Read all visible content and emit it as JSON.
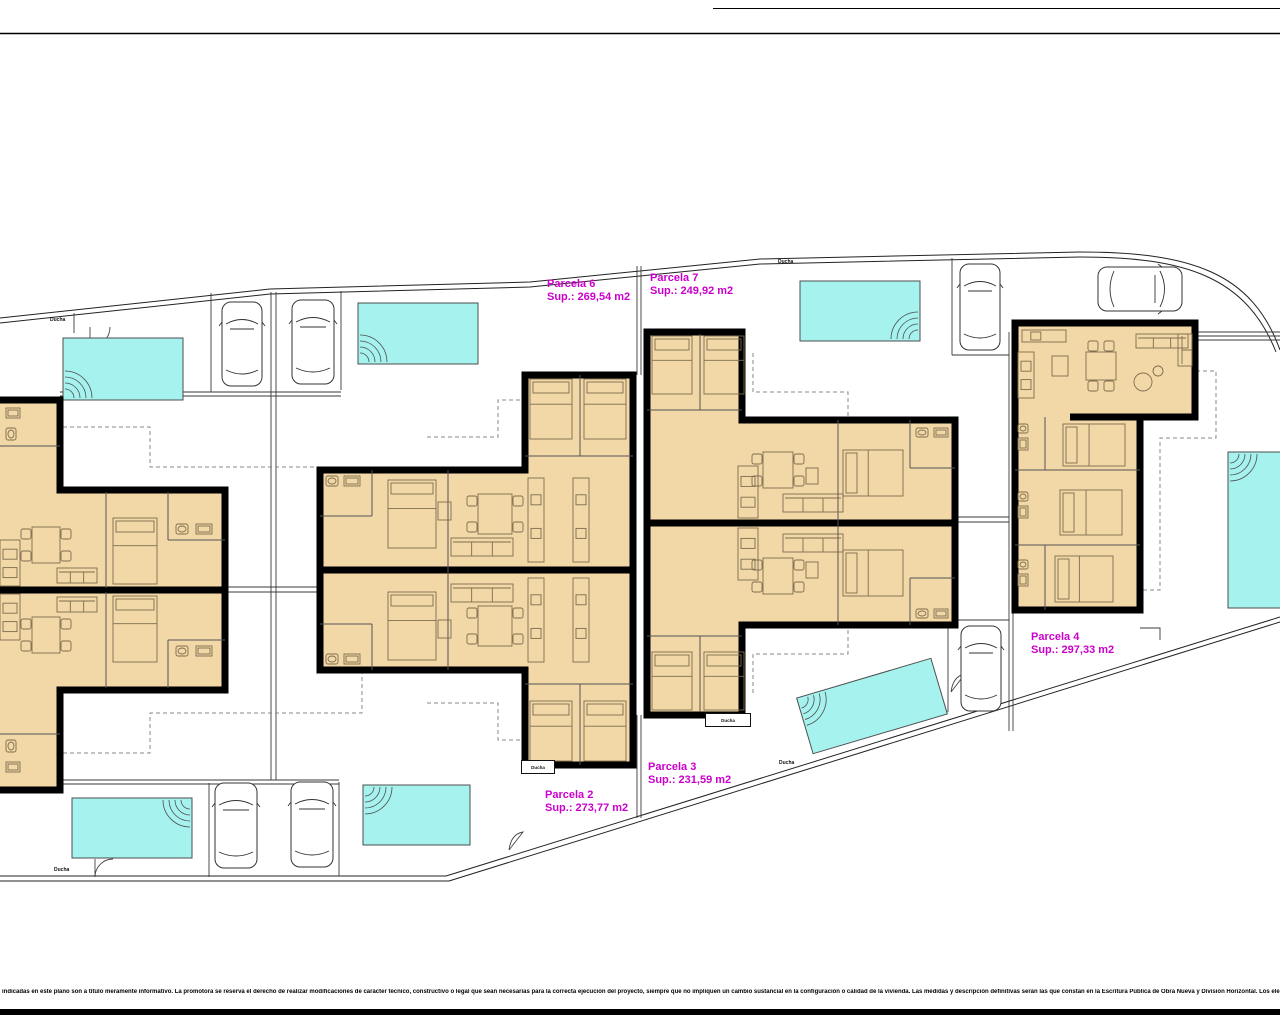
{
  "title": "Plano de distribución de parcelas",
  "colors": {
    "wall": "#000000",
    "room_fill": "#f2d8a7",
    "pool": "#a6f2ef",
    "pool_edge": "#4d4d4d",
    "label": "#cc00cc",
    "line": "#3a3a3a",
    "boundary": "#222222",
    "furniture": "#7d6c4e",
    "dash": "#888888",
    "car_line": "#333333"
  },
  "disclaimer": {
    "text": "indicadas en este plano son a título meramente informativo. La promotora se reserva el derecho de realizar modificaciones de carácter técnico, constructivo o legal que sean necesarias para la correcta ejecución del proyecto, siempre que no impliquen un cambio sustancial en la configuración o calidad de la vivienda. Las medidas y descripción definitivas serán las que constan en la Escritura Pública de Obra Nueva y División Horizontal. Los elementos de mobiliario y decoración son meramente orientativos."
  },
  "parcels": [
    {
      "name": "Parcela 6",
      "sup": "Sup.: 269,54 m2",
      "x": 547,
      "y": 278
    },
    {
      "name": "Parcela 7",
      "sup": "Sup.: 249,92 m2",
      "x": 650,
      "y": 272
    },
    {
      "name": "Parcela 2",
      "sup": "Sup.: 273,77 m2",
      "x": 545,
      "y": 789
    },
    {
      "name": "Parcela 3",
      "sup": "Sup.: 231,59 m2",
      "x": 648,
      "y": 761
    },
    {
      "name": "Parcela 4",
      "sup": "Sup.: 297,33 m2",
      "x": 1031,
      "y": 631
    }
  ],
  "shower_labels": {
    "text": "Ducha",
    "plain": [
      [
        50,
        317
      ],
      [
        778,
        259
      ],
      [
        779,
        760
      ],
      [
        54,
        867
      ]
    ],
    "boxed": [
      [
        521,
        760,
        34,
        14
      ],
      [
        705,
        713,
        46,
        14
      ]
    ]
  },
  "site": {
    "border_lines": [
      "M0,33.5 H1280",
      "M713,8.5 H1280"
    ],
    "bottom_bar": {
      "x": 0,
      "y": 1009,
      "w": 1280,
      "h": 6
    },
    "boundary": [
      "M0,318 L270,289 L530,282 L760,259 L1080,252 C1190,252 1252,272 1280,350",
      "M0,323 L270,294 L530,287 L760,264 L1080,257 C1186,257 1246,277 1276,352",
      "M-2,876 H446",
      "M-2,881 H449",
      "M446,876 L1280,617",
      "M449,881 L1280,622"
    ],
    "thin": [
      "M637,266 V375",
      "M641,266 V375",
      "M637,715 V818",
      "M641,715 V818",
      "M1009,332 V731",
      "M1013,332 V731",
      "M271,292 V780",
      "M276,292 V780",
      "M225,587 H320",
      "M225,592 H320",
      "M955,517 H1009",
      "M955,522 H1009",
      "M1196,332 H1280",
      "M1196,336 H1280",
      "M1196,340 H1280",
      "M211,293 V392",
      "M341,291 V390",
      "M60,392 H341",
      "M60,396 H341",
      "M209,783 V877",
      "M339,782 V876",
      "M60,780 H339",
      "M60,784 H339",
      "M952,258 V355",
      "M952,355 H1009",
      "M948,620 V712",
      "M948,620 H1009",
      "M1140,628 H1160 V640",
      "M74,313 V333"
    ],
    "dashed": [
      "M28,427 H150 V467 H362 V556",
      "M28,753 H150 V713 H362 V628",
      "M427,437 H498 V400 H553",
      "M427,703 H498 V740 H553",
      "M753,353 V392 H848 V418",
      "M753,693 V654 H848 V628",
      "M1196,371 H1216 V438 H1160 V590 H1142"
    ],
    "gates": [
      "M110,327 A20 20 0 0 1 90,347 L90,327",
      "M95,859 L95,877 A18 18 0 0 1 113,859",
      "M509,850 q2,-16 14,-18 l-14,18",
      "M951,692 q2,-16 14,-18 l-14,18"
    ]
  },
  "pools": [
    {
      "x": 63,
      "y": 338,
      "w": 120,
      "h": 62,
      "steps": "bl"
    },
    {
      "x": 358,
      "y": 303,
      "w": 120,
      "h": 61,
      "steps": "bl"
    },
    {
      "x": 800,
      "y": 281,
      "w": 120,
      "h": 60,
      "steps": "br"
    },
    {
      "x": 1228,
      "y": 452,
      "w": 68,
      "h": 156,
      "steps": "tl"
    },
    {
      "x": 72,
      "y": 798,
      "w": 120,
      "h": 60,
      "steps": "tr"
    },
    {
      "x": 363,
      "y": 785,
      "w": 107,
      "h": 60,
      "steps": "tl"
    },
    {
      "x": 802,
      "y": 677,
      "w": 140,
      "h": 58,
      "steps": "tl",
      "rot": -16.5,
      "cx": 872,
      "cy": 706
    }
  ],
  "cars": [
    {
      "x": 222,
      "y": 302,
      "w": 40,
      "h": 84,
      "rot": 0
    },
    {
      "x": 292,
      "y": 300,
      "w": 42,
      "h": 84,
      "rot": 0
    },
    {
      "x": 960,
      "y": 264,
      "w": 40,
      "h": 86,
      "rot": 0
    },
    {
      "x": 1118,
      "y": 247,
      "w": 44,
      "h": 84,
      "rot": 90
    },
    {
      "x": 961,
      "y": 626,
      "w": 40,
      "h": 85,
      "rot": 0
    },
    {
      "x": 215,
      "y": 783,
      "w": 42,
      "h": 85,
      "rot": 0
    },
    {
      "x": 291,
      "y": 782,
      "w": 42,
      "h": 85,
      "rot": 0
    }
  ],
  "houses": [
    {
      "name": "house-pair-parcela-1-5",
      "outline": "M-14,400 H60 V490 H225 V690 H60 V790 H-14 Z",
      "walls": [
        "M-14,590 H225"
      ],
      "partitions": [
        "M106,492 V588",
        "M168,492 V540",
        "M168,540 H225",
        "M0,446 H60",
        "M106,592 V688",
        "M168,640 V688",
        "M168,640 H225",
        "M0,734 H60"
      ],
      "furniture": [
        [
          "table4",
          32,
          527,
          28,
          36
        ],
        [
          "sofa",
          57,
          568,
          40,
          15
        ],
        [
          "bed",
          113,
          518,
          44,
          66
        ],
        [
          "wc",
          176,
          524,
          12,
          10
        ],
        [
          "sink",
          196,
          524,
          16,
          10
        ],
        [
          "counter",
          0,
          540,
          20,
          46
        ],
        [
          "sink",
          6,
          408,
          14,
          10
        ],
        [
          "wc",
          6,
          428,
          10,
          12
        ],
        [
          "table4",
          32,
          617,
          28,
          36
        ],
        [
          "sofa",
          57,
          597,
          40,
          15
        ],
        [
          "bed",
          113,
          596,
          44,
          66
        ],
        [
          "wc",
          176,
          646,
          12,
          10
        ],
        [
          "sink",
          196,
          646,
          16,
          10
        ],
        [
          "counter",
          0,
          594,
          20,
          46
        ],
        [
          "sink",
          6,
          762,
          14,
          10
        ],
        [
          "wc",
          6,
          740,
          10,
          12
        ]
      ]
    },
    {
      "name": "house-pair-parcela-6-2",
      "outline": "M320,470 H525 V375 H633 V765 H525 V670 H320 Z",
      "walls": [
        "M320,570 H633"
      ],
      "partitions": [
        "M372,470 V516",
        "M320,516 H372",
        "M448,470 V570",
        "M580,375 V456",
        "M525,456 H633",
        "M372,624 V670",
        "M320,624 H372",
        "M448,570 V670",
        "M580,684 V765",
        "M525,684 H633"
      ],
      "furniture": [
        [
          "bed",
          388,
          480,
          48,
          68
        ],
        [
          "table4",
          478,
          494,
          34,
          40
        ],
        [
          "sofa",
          451,
          538,
          62,
          18
        ],
        [
          "sq",
          438,
          502,
          13,
          18
        ],
        [
          "wc",
          326,
          476,
          12,
          10
        ],
        [
          "sink",
          344,
          476,
          16,
          10
        ],
        [
          "counter",
          528,
          478,
          16,
          84
        ],
        [
          "counter",
          573,
          478,
          16,
          84
        ],
        [
          "bed",
          530,
          379,
          42,
          60
        ],
        [
          "bed",
          584,
          379,
          42,
          60
        ],
        [
          "bed",
          388,
          592,
          48,
          68
        ],
        [
          "table4",
          478,
          606,
          34,
          40
        ],
        [
          "sofa",
          451,
          584,
          62,
          18
        ],
        [
          "sq",
          438,
          620,
          13,
          18
        ],
        [
          "wc",
          326,
          654,
          12,
          10
        ],
        [
          "sink",
          344,
          654,
          16,
          10
        ],
        [
          "counter",
          528,
          578,
          16,
          84
        ],
        [
          "counter",
          573,
          578,
          16,
          84
        ],
        [
          "bed",
          530,
          701,
          42,
          60
        ],
        [
          "bed",
          584,
          701,
          42,
          60
        ]
      ]
    },
    {
      "name": "house-pair-parcela-7-3",
      "outline": "M647,332 H742 V420 H955 V625 H742 V715 H647 Z",
      "walls": [
        "M647,523 H955"
      ],
      "partitions": [
        "M700,334 V410",
        "M647,410 H742",
        "M838,420 V523",
        "M910,420 V468",
        "M910,468 H955",
        "M700,636 V712",
        "M647,636 H742",
        "M838,523 V625",
        "M910,578 V625",
        "M910,578 H955"
      ],
      "furniture": [
        [
          "bed",
          652,
          336,
          40,
          58
        ],
        [
          "bed",
          704,
          336,
          40,
          58
        ],
        [
          "counter",
          738,
          466,
          20,
          52
        ],
        [
          "table4",
          763,
          452,
          30,
          36
        ],
        [
          "sq",
          806,
          468,
          12,
          16
        ],
        [
          "sofa",
          783,
          494,
          60,
          18
        ],
        [
          "bed_h",
          843,
          450,
          60,
          46
        ],
        [
          "wc",
          916,
          428,
          12,
          9
        ],
        [
          "sink",
          934,
          428,
          14,
          9
        ],
        [
          "bed",
          652,
          652,
          40,
          58
        ],
        [
          "bed",
          704,
          652,
          40,
          58
        ],
        [
          "counter",
          738,
          528,
          20,
          52
        ],
        [
          "table4",
          763,
          558,
          30,
          36
        ],
        [
          "sq",
          806,
          562,
          12,
          16
        ],
        [
          "sofa",
          783,
          534,
          60,
          18
        ],
        [
          "bed_h",
          843,
          550,
          60,
          46
        ],
        [
          "wc",
          916,
          609,
          12,
          9
        ],
        [
          "sink",
          934,
          609,
          14,
          9
        ]
      ]
    },
    {
      "name": "house-parcela-4",
      "outline": "M1015,323 H1195 V417 H1140 V610 H1015 Z",
      "walls": [
        "M1070,417 H1140"
      ],
      "partitions": [
        "M1045,417 V470",
        "M1015,470 H1140",
        "M1015,545 H1140",
        "M1045,545 V610"
      ],
      "furniture": [
        [
          "counter",
          1018,
          352,
          16,
          46
        ],
        [
          "counter",
          1022,
          330,
          44,
          12
        ],
        [
          "sq",
          1052,
          356,
          16,
          20
        ],
        [
          "table4",
          1086,
          352,
          30,
          28
        ],
        [
          "sofa",
          1136,
          334,
          52,
          14
        ],
        [
          "sofa_v",
          1178,
          334,
          14,
          32
        ],
        [
          "circle",
          1143,
          382,
          9,
          9
        ],
        [
          "circle",
          1158,
          371,
          5,
          5
        ],
        [
          "wc",
          1018,
          424,
          10,
          9
        ],
        [
          "sink",
          1018,
          438,
          10,
          12
        ],
        [
          "bed_h",
          1063,
          424,
          62,
          42
        ],
        [
          "wc",
          1018,
          492,
          10,
          9
        ],
        [
          "sink",
          1018,
          506,
          10,
          12
        ],
        [
          "bed_h",
          1060,
          490,
          62,
          45
        ],
        [
          "wc",
          1018,
          560,
          10,
          9
        ],
        [
          "sink",
          1018,
          574,
          10,
          12
        ],
        [
          "bed_h",
          1055,
          556,
          58,
          46
        ]
      ]
    }
  ]
}
